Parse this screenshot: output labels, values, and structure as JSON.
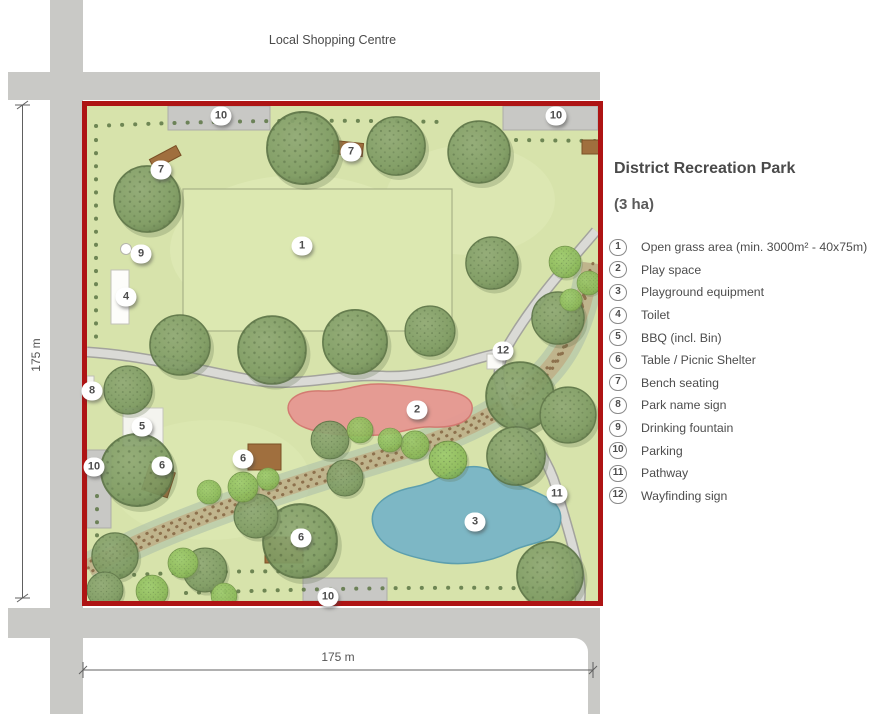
{
  "surroundings": {
    "top_label": "Local Shopping Centre"
  },
  "dimensions": {
    "left_label": "175 m",
    "bottom_label": "175 m"
  },
  "legend": {
    "title": "District Recreation Park",
    "subtitle": "(3 ha)",
    "items": [
      {
        "num": "1",
        "label": "Open grass area (min. 3000m² - 40x75m)"
      },
      {
        "num": "2",
        "label": "Play space"
      },
      {
        "num": "3",
        "label": "Playground equipment"
      },
      {
        "num": "4",
        "label": "Toilet"
      },
      {
        "num": "5",
        "label": "BBQ (incl. Bin)"
      },
      {
        "num": "6",
        "label": "Table / Picnic Shelter"
      },
      {
        "num": "7",
        "label": "Bench seating"
      },
      {
        "num": "8",
        "label": "Park name sign"
      },
      {
        "num": "9",
        "label": "Drinking fountain"
      },
      {
        "num": "10",
        "label": "Parking"
      },
      {
        "num": "11",
        "label": "Pathway"
      },
      {
        "num": "12",
        "label": "Wayfinding sign"
      }
    ]
  },
  "map": {
    "markers": [
      {
        "label": "10",
        "feature": "Parking"
      },
      {
        "label": "10",
        "feature": "Parking"
      },
      {
        "label": "7",
        "feature": "Bench seating"
      },
      {
        "label": "7",
        "feature": "Bench seating"
      },
      {
        "label": "1",
        "feature": "Open grass area"
      },
      {
        "label": "9",
        "feature": "Drinking fountain"
      },
      {
        "label": "4",
        "feature": "Toilet"
      },
      {
        "label": "12",
        "feature": "Wayfinding sign"
      },
      {
        "label": "8",
        "feature": "Park name sign"
      },
      {
        "label": "2",
        "feature": "Play space"
      },
      {
        "label": "5",
        "feature": "BBQ (incl. Bin)"
      },
      {
        "label": "6",
        "feature": "Table / Picnic Shelter"
      },
      {
        "label": "6",
        "feature": "Table / Picnic Shelter"
      },
      {
        "label": "10",
        "feature": "Parking"
      },
      {
        "label": "11",
        "feature": "Pathway"
      },
      {
        "label": "3",
        "feature": "Playground equipment"
      },
      {
        "label": "6",
        "feature": "Table / Picnic Shelter"
      },
      {
        "label": "10",
        "feature": "Parking"
      }
    ]
  },
  "colors": {
    "plan_border_red": "#ae1414",
    "road_gray": "#c9c9c6",
    "park_green": "#d7e3ab",
    "tree_olive": "#7d9a62",
    "tree_bright": "#8ab857",
    "play_space_pink": "#e69892",
    "playground_blue": "#7db7c5",
    "path_gray": "#d9d9d5",
    "creek_tan": "#bb9a72",
    "structure_brown": "#a06f3e",
    "text_gray": "#4c4c4c"
  }
}
